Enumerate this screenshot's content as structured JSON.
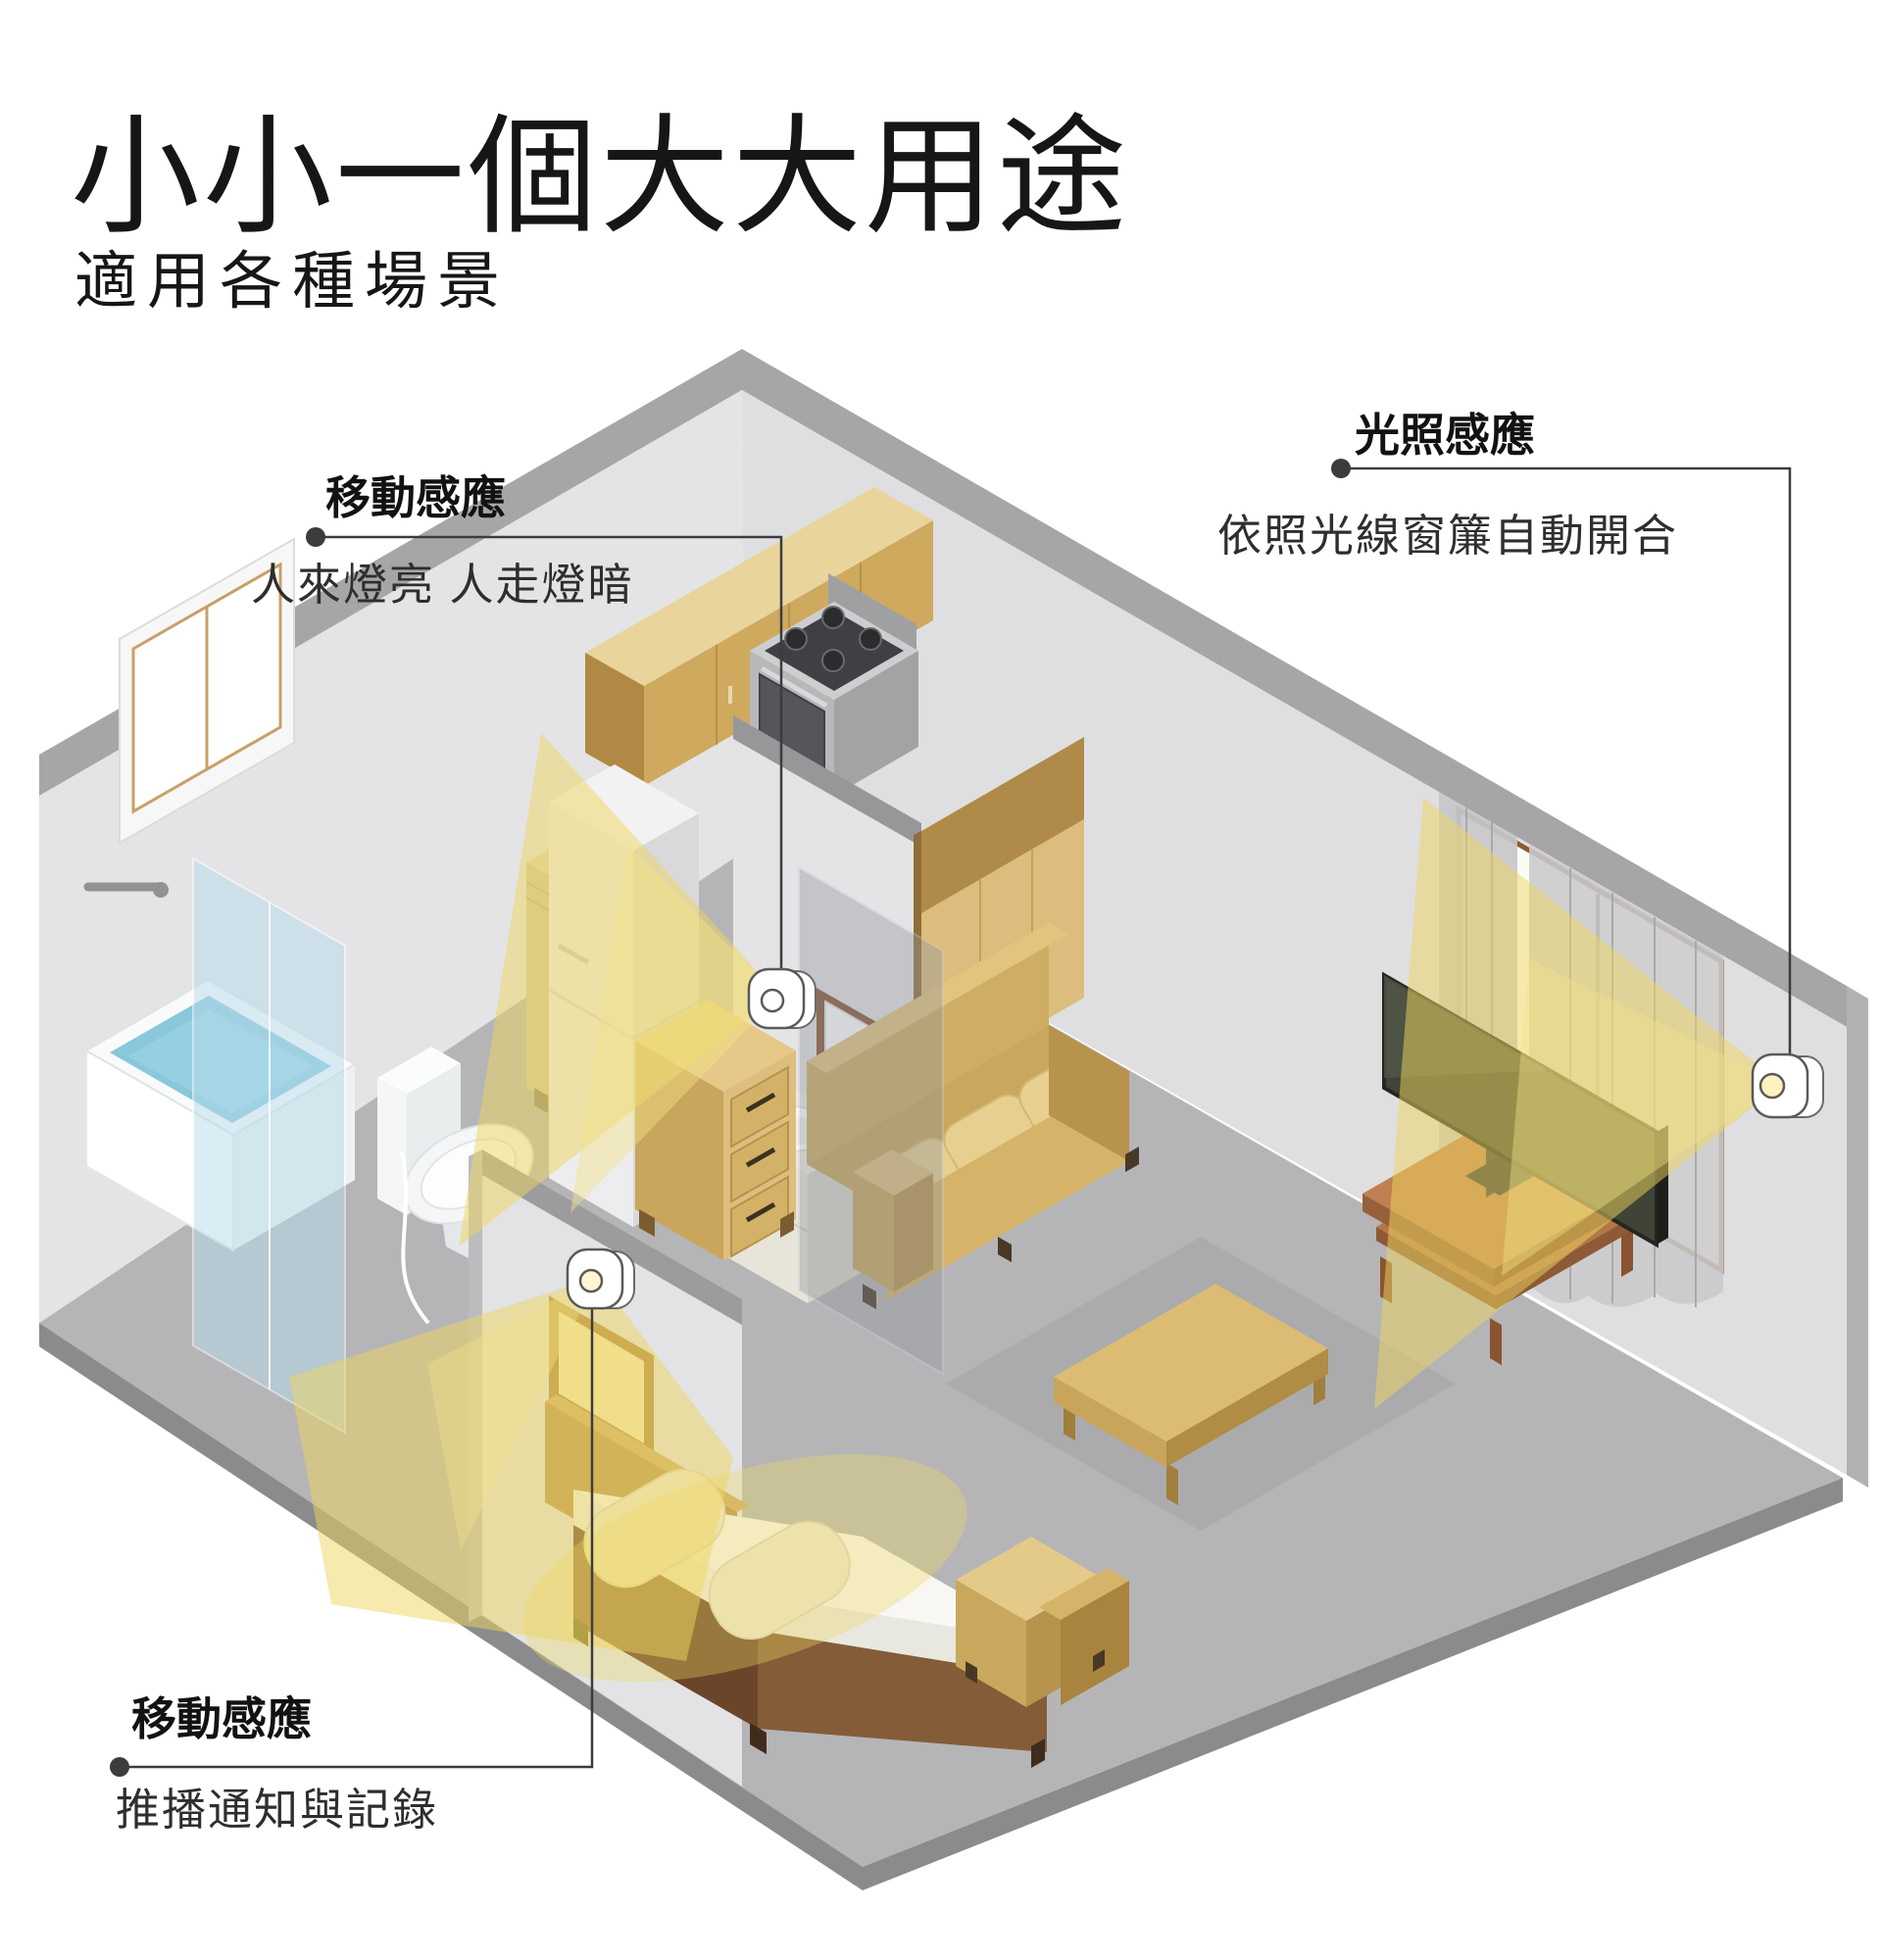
{
  "title": "小小一個大大用途",
  "subtitle": "適用各種場景",
  "annotations": {
    "motion_kitchen": {
      "label": "移動感應",
      "description": "人來燈亮 人走燈暗"
    },
    "light_curtain": {
      "label": "光照感應",
      "description": "依照光線窗簾自動開合"
    },
    "motion_bedroom": {
      "label": "移動感應",
      "description": "推播通知與記錄"
    }
  },
  "colors": {
    "accent_light": "#edd65f",
    "wall": "#e3e3e5",
    "floor": "#b5b5b7",
    "furniture_tan": "#d9b86e",
    "wood_brown": "#b5764a",
    "leader_line": "#3c3c3e"
  },
  "scene": {
    "sensor_count": 3,
    "items": [
      "kitchen-cabinets",
      "stove",
      "fridge",
      "kitchen-counter",
      "bathtub",
      "shower-glass",
      "toilet",
      "sink-vanity",
      "mirror",
      "tall-cabinet",
      "bed",
      "picture-frame",
      "dresser",
      "sofa",
      "coffee-table",
      "armchair",
      "rug",
      "tv",
      "tv-stand",
      "left-window",
      "right-window",
      "curtains"
    ]
  }
}
